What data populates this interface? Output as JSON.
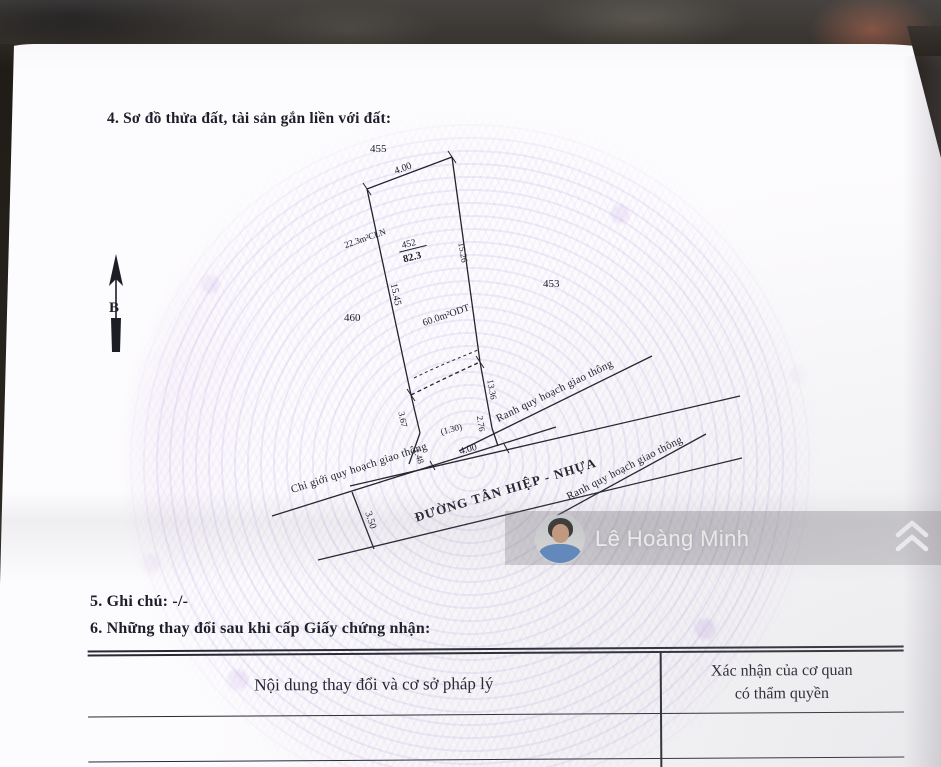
{
  "document": {
    "section4_title": "4. Sơ đồ thửa đất, tài sản gắn liền với đất:",
    "section5_text": "5. Ghi chú: -/-",
    "section6_text": "6. Những thay đổi sau khi cấp Giấy chứng nhận:",
    "table": {
      "col1_header": "Nội dung thay đổi và cơ sở pháp lý",
      "col2_header_line1": "Xác nhận của cơ quan",
      "col2_header_line2": "có thẩm quyền"
    }
  },
  "diagram": {
    "north_label": "B",
    "neighbor_parcels": {
      "top": "455",
      "left": "460",
      "right": "453"
    },
    "subject_parcel": {
      "number": "452",
      "total_area": "82.3",
      "cln_area": "22.3m²CLN",
      "odt_area": "60.0m²ODT"
    },
    "dimensions": {
      "top_edge": "4.00",
      "left_edge": "15.45",
      "right_edge": "15.26",
      "right_lower": "13.36",
      "bottom_left": "3.67",
      "bottom_right": "2.76",
      "gap": "(1.30)",
      "short_left": "1.48",
      "frontage": "4.00",
      "road_width": "3.50"
    },
    "labels": {
      "road_name": "ĐƯỜNG TÂN HIỆP - NHỰA",
      "planning_boundary_upper": "Ranh quy hoạch giao thông",
      "planning_boundary_lower": "Ranh quy hoạch giao thông",
      "road_redline": "Chỉ giới quy hoạch giao thông"
    }
  },
  "watermark": {
    "user_name": "Lê Hoàng Minh"
  },
  "icons": {
    "share": "double-chevron-up-icon",
    "north_arrow": "north-arrow-icon"
  },
  "colors": {
    "pattern_accent": "#c9b6e6",
    "ink": "#23232e",
    "paper": "#fcfbfd",
    "surround": "#26221c"
  }
}
